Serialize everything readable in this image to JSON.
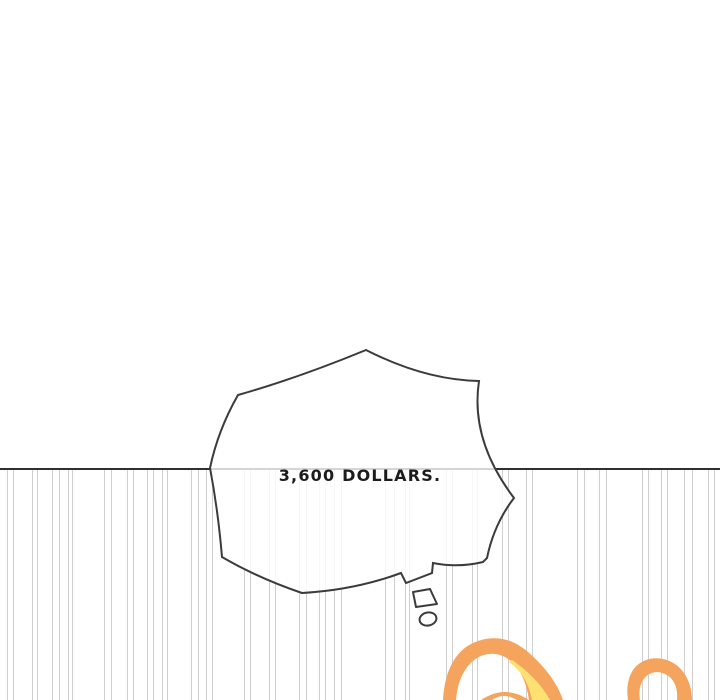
{
  "comic": {
    "dialogue": {
      "thought_text": "3,600 DOLLARS."
    },
    "colors": {
      "background": "#ffffff",
      "ink": "#3b3b3b",
      "panel_line": "#2f2f2f",
      "speed_line": "#cfcfcf",
      "text": "#1c1c1c",
      "hair_orange": "#f4a45c",
      "hair_yellow": "#ffe173"
    },
    "decor": {
      "speed_line_groups": [
        {
          "x": 10,
          "w": 7
        },
        {
          "x": 35,
          "w": 6
        },
        {
          "x": 56,
          "w": 8
        },
        {
          "x": 70,
          "w": 5
        },
        {
          "x": 108,
          "w": 8
        },
        {
          "x": 130,
          "w": 7
        },
        {
          "x": 150,
          "w": 7
        },
        {
          "x": 165,
          "w": 6
        },
        {
          "x": 195,
          "w": 8
        },
        {
          "x": 209,
          "w": 7
        },
        {
          "x": 247,
          "w": 7
        },
        {
          "x": 272,
          "w": 7
        },
        {
          "x": 303,
          "w": 8
        },
        {
          "x": 322,
          "w": 7
        },
        {
          "x": 338,
          "w": 8
        },
        {
          "x": 390,
          "w": 10
        },
        {
          "x": 407,
          "w": 5
        },
        {
          "x": 449,
          "w": 7
        },
        {
          "x": 475,
          "w": 6
        },
        {
          "x": 505,
          "w": 7
        },
        {
          "x": 529,
          "w": 7
        },
        {
          "x": 581,
          "w": 8
        },
        {
          "x": 603,
          "w": 8
        },
        {
          "x": 645,
          "w": 7
        },
        {
          "x": 664,
          "w": 7
        },
        {
          "x": 688,
          "w": 9
        },
        {
          "x": 711,
          "w": 7
        }
      ]
    }
  }
}
